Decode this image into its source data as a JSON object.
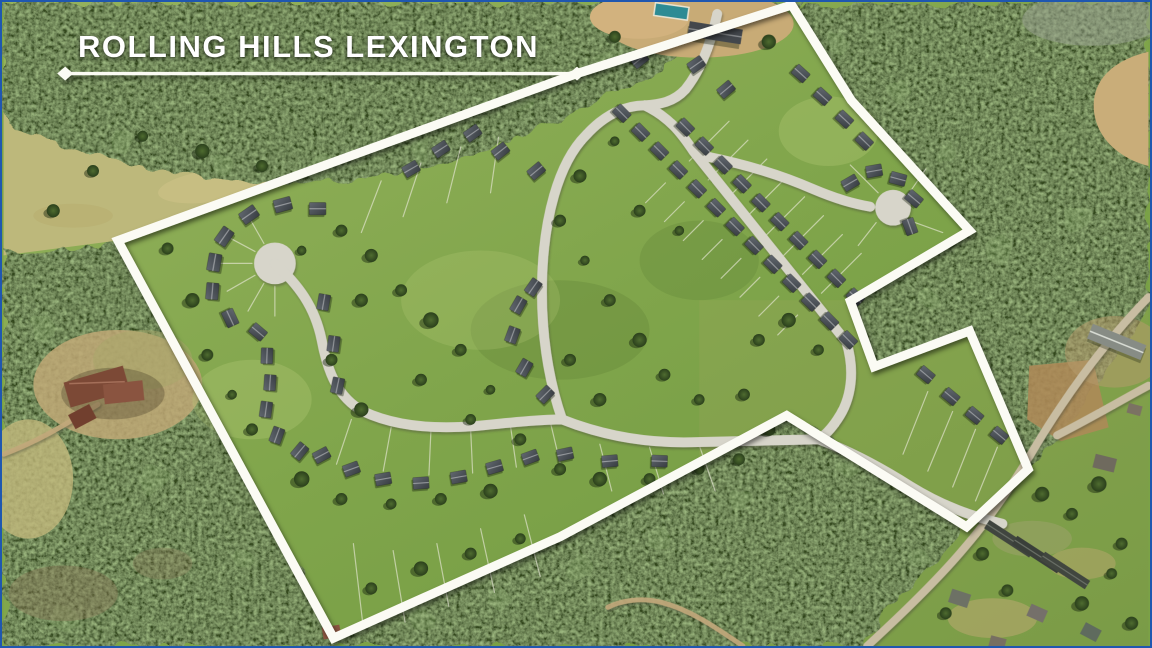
{
  "title": {
    "text": "ROLLING HILLS LEXINGTON"
  },
  "overlay": {
    "boundary_points": "577,72 793,3 853,99 972,230 852,301 876,367 972,331 1031,470 969,528 788,416 560,538 332,640 115,240",
    "underline_points": "62,72 577,72",
    "diamond_left_points": "54,72 62,65 70,72 62,79",
    "diamond_right_points": "569,72 577,65 585,72 577,79",
    "colors": {
      "boundary_line": "#fbfbf4",
      "title_text": "#ffffff",
      "frame_border": "#1f57b0"
    }
  },
  "palette": {
    "lawn_green": "#84a74e",
    "forest_green": "#31471f",
    "meadow_tan": "#bdb87b",
    "road_gray": "#d7d5ca",
    "rural_road_tan": "#c8bda2",
    "roof_gray": "#454a50",
    "pool_teal": "#2d8b94",
    "mansion_roof": "#7c4936"
  }
}
